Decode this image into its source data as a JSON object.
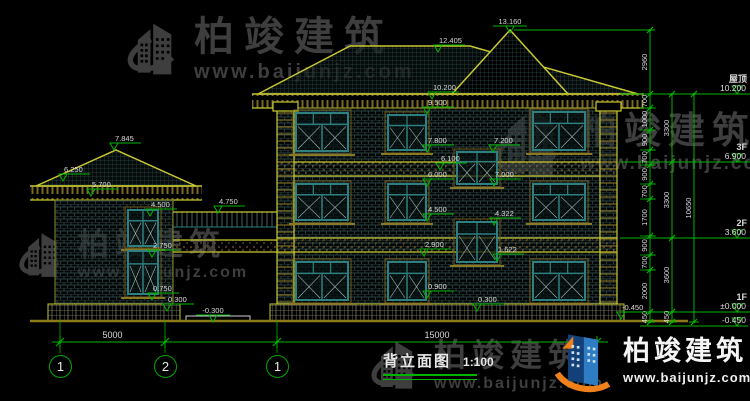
{
  "watermark": {
    "brand": "柏竣建筑",
    "site": "www.baijunjz.com"
  },
  "logo": {
    "brand": "柏竣建筑",
    "site": "www.baijunjz.com"
  },
  "title": {
    "name": "背立面图",
    "scale": "1:100"
  },
  "axes": [
    {
      "label": "1"
    },
    {
      "label": "2"
    },
    {
      "label": "1"
    }
  ],
  "colors": {
    "dim_green": "#00b400",
    "text": "#d9d9d9",
    "outline_yellow": "#c8c832",
    "frame_teal": "#2e8080",
    "watermark_gray": "#3e3e3e",
    "logo_navy": "#14407a",
    "logo_blue": "#2e7cc3",
    "logo_orange": "#f08019"
  },
  "bottom_dims": [
    {
      "label": "5000",
      "x1": 60,
      "x2": 165
    },
    {
      "label": "15000",
      "x1": 277,
      "x2": 597
    }
  ],
  "floor_markers": [
    {
      "floor": "屋顶",
      "elev": "10.200",
      "y": 94
    },
    {
      "floor": "3F",
      "elev": "6.900",
      "y": 162
    },
    {
      "floor": "2F",
      "elev": "3.600",
      "y": 238
    },
    {
      "floor": "1F",
      "elev": "±0.000",
      "y": 312
    },
    {
      "floor": "",
      "elev": "-0.450",
      "y": 326
    }
  ],
  "elevation_markers": [
    {
      "label": "13.160",
      "x": 510,
      "y": 33,
      "align": "c"
    },
    {
      "label": "12.405",
      "x": 438,
      "y": 52,
      "align": "r"
    },
    {
      "label": "10.200",
      "x": 432,
      "y": 99,
      "align": "r"
    },
    {
      "label": "9.500",
      "x": 427,
      "y": 114,
      "align": "r"
    },
    {
      "label": "7.800",
      "x": 427,
      "y": 152,
      "align": "r"
    },
    {
      "label": "6.100",
      "x": 440,
      "y": 170,
      "align": "r"
    },
    {
      "label": "6.000",
      "x": 427,
      "y": 186,
      "align": "r"
    },
    {
      "label": "4.500",
      "x": 427,
      "y": 221,
      "align": "r"
    },
    {
      "label": "2.900",
      "x": 424,
      "y": 256,
      "align": "r"
    },
    {
      "label": "0.900",
      "x": 427,
      "y": 298,
      "align": "r"
    },
    {
      "label": "0.300",
      "x": 477,
      "y": 311,
      "align": "r"
    },
    {
      "label": "7.200",
      "x": 493,
      "y": 152,
      "align": "r"
    },
    {
      "label": "7.000",
      "x": 494,
      "y": 186,
      "align": "r"
    },
    {
      "label": "4.322",
      "x": 494,
      "y": 225,
      "align": "r"
    },
    {
      "label": "1.622",
      "x": 497,
      "y": 261,
      "align": "r"
    },
    {
      "label": "-0.450",
      "x": 621,
      "y": 319,
      "align": "r"
    },
    {
      "label": "-0.300",
      "x": 213,
      "y": 322,
      "align": "c"
    },
    {
      "label": "7.845",
      "x": 114,
      "y": 150,
      "align": "r"
    },
    {
      "label": "6.250",
      "x": 63,
      "y": 181,
      "align": "r"
    },
    {
      "label": "5.700",
      "x": 91,
      "y": 196,
      "align": "r"
    },
    {
      "label": "4.500",
      "x": 150,
      "y": 216,
      "align": "r"
    },
    {
      "label": "2.750",
      "x": 152,
      "y": 257,
      "align": "r"
    },
    {
      "label": "0.750",
      "x": 152,
      "y": 300,
      "align": "r"
    },
    {
      "label": "0.300",
      "x": 167,
      "y": 311,
      "align": "r"
    },
    {
      "label": "4.750",
      "x": 218,
      "y": 213,
      "align": "r"
    }
  ],
  "dim_chains": [
    {
      "x": 650,
      "ticks": [
        30,
        94,
        108,
        130,
        150,
        165,
        184,
        199,
        236,
        255,
        270,
        312,
        322
      ],
      "labels": [
        "2960",
        "700",
        "1000",
        "900",
        "700",
        "900",
        "700",
        "1700",
        "900",
        "700",
        "2000",
        "450"
      ]
    },
    {
      "x": 672,
      "ticks": [
        94,
        162,
        238,
        312,
        322
      ],
      "labels": [
        "3300",
        "3300",
        "3600",
        "450"
      ]
    },
    {
      "x": 694,
      "ticks": [
        94,
        322
      ],
      "labels": [
        "10650"
      ]
    }
  ]
}
